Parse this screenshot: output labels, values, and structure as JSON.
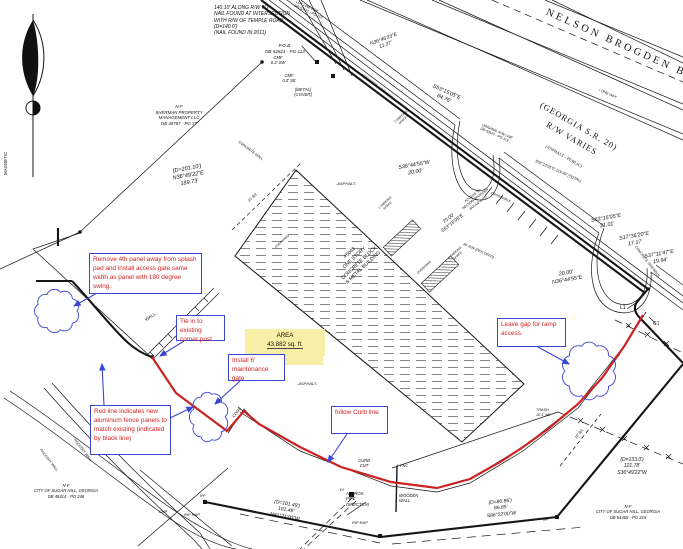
{
  "drawing_title": "site plat with fence markup",
  "area": {
    "title": "AREA",
    "value": "43,882  sq. ft."
  },
  "colors": {
    "redline": "#cc2222",
    "markup_blue": "#3a45d6",
    "callout_text": "#d42222",
    "highlight": "#f7efa6",
    "ink": "#111111"
  },
  "callouts": [
    {
      "n": "callout-remove-panel",
      "t": "Remove 4th panel away from splash pad and install access gate same width as panel with 180 degree swing.",
      "x": 89,
      "y": 253,
      "w": 113,
      "h": 41
    },
    {
      "n": "callout-tie-in",
      "t": "Tie in to existing corner post.",
      "x": 176,
      "y": 315,
      "w": 49,
      "h": 26
    },
    {
      "n": "callout-install-gate",
      "t": "Install 6' maintenance gate",
      "x": 228,
      "y": 354,
      "w": 57,
      "h": 27
    },
    {
      "n": "callout-red-line",
      "t": "Red line indicates new aluminum fence panels to match existing (indicated by black line)",
      "x": 90,
      "y": 405,
      "w": 81,
      "h": 50
    },
    {
      "n": "callout-follow-curb",
      "t": "follow Curb line",
      "x": 331,
      "y": 406,
      "w": 57,
      "h": 28
    },
    {
      "n": "callout-leave-gap",
      "t": "Leave gap for ramp access.",
      "x": 497,
      "y": 318,
      "w": 69,
      "h": 29
    }
  ],
  "labels": [
    {
      "n": "note-nail",
      "t": "140.10' ALONG R/W TO\nNAIL FOUND AT INTERSECTION\nWITH R/W OF TEMPLE ROAD\n(D=140.0')\n(NAIL FOUND IN 2011)",
      "x": 214,
      "y": 5,
      "s": 5,
      "i": 1
    },
    {
      "n": "pob",
      "t": "P.O.B.\nDB 52621 - PG 113",
      "x": 253,
      "y": 43,
      "s": 4.6,
      "a": "c",
      "w": 64,
      "i": 1
    },
    {
      "n": "cmf-sw",
      "t": "CMF\n0.3' SW",
      "x": 266,
      "y": 55,
      "s": 4.2,
      "a": "c",
      "w": 24,
      "i": 1
    },
    {
      "n": "cmf-se",
      "t": "CMF\n0.3' SE",
      "x": 277,
      "y": 73,
      "s": 4.2,
      "a": "c",
      "w": 24,
      "i": 1
    },
    {
      "n": "metal-cover",
      "t": "(METAL)\n(COVER)",
      "x": 289,
      "y": 87,
      "s": 4.2,
      "a": "c",
      "w": 28,
      "i": 1
    },
    {
      "n": "brg-n364623e",
      "t": "N36°46'23\"E\n11.37'",
      "x": 362,
      "y": 44,
      "s": 5,
      "i": 1,
      "r": -20,
      "a": "c",
      "w": 44
    },
    {
      "n": "owner-sherman",
      "t": "N-F\nSHERMAN PROPERTY\nMANAGEMENT LLC\nDB 40787 - PG 77",
      "x": 140,
      "y": 104,
      "s": 4.4,
      "a": "c",
      "w": 78,
      "i": 1
    },
    {
      "n": "brg-n364922e",
      "t": "(D=201.10')\nN36°49'22\"E\n189.73'",
      "x": 158,
      "y": 171,
      "s": 5.6,
      "i": 1,
      "r": -10,
      "a": "c",
      "w": 58
    },
    {
      "n": "brg-s531505e-84",
      "t": "S53°15'05\"E\n84.76'",
      "x": 424,
      "y": 79,
      "s": 5.4,
      "i": 1,
      "r": 24,
      "a": "c",
      "w": 52
    },
    {
      "n": "road-name",
      "t": "NELSON BROGDEN BOULEVARD",
      "x": 549,
      "y": 6,
      "s": 10.5,
      "r": 24,
      "serif": 1,
      "ls": 3,
      "w": 320
    },
    {
      "n": "road-designation",
      "t": "(GEORGIA S.R. 20)\nR/W VARIES",
      "x": 534,
      "y": 92,
      "s": 8.5,
      "r": 30,
      "serif": 1,
      "ls": 1,
      "a": "c",
      "w": 112,
      "lh": 1.7
    },
    {
      "n": "road-surface",
      "t": "(ASPHALT - PUBLIC)",
      "x": 534,
      "y": 136,
      "s": 4.4,
      "r": 30,
      "serif": 1,
      "a": "c",
      "w": 72
    },
    {
      "n": "one-way",
      "t": "• ONE WAY",
      "x": 600,
      "y": 88,
      "s": 3.6,
      "r": 24
    },
    {
      "n": "lot-line-note",
      "t": "LOT LINE PER\nDB 52621 - PG 113",
      "x": 297,
      "y": 0,
      "s": 3.5,
      "r": 24,
      "i": 1
    },
    {
      "n": "orig-rw-note",
      "t": "ORIGINAL R/W LINE\nDB 52621 - PG 113",
      "x": 483,
      "y": 123,
      "s": 3.5,
      "r": 24,
      "i": 1
    },
    {
      "n": "brg-s531505e-total",
      "t": "S53°15'05\"E 219.49' (TOTAL)",
      "x": 536,
      "y": 159,
      "s": 3.8,
      "r": 24,
      "i": 1
    },
    {
      "n": "brg-s364455w",
      "t": "S36°44'55\"W\n20.00'",
      "x": 387,
      "y": 167,
      "s": 5.4,
      "i": 1,
      "r": -10,
      "a": "c",
      "w": 54
    },
    {
      "n": "crosswalk",
      "t": "CROSSWALK",
      "x": 492,
      "y": 191,
      "s": 3.4,
      "r": 24
    },
    {
      "n": "concrete-sidewalk-1",
      "t": "CONCRETE SIDEWALK",
      "x": 363,
      "y": 73,
      "s": 3.5,
      "r": 37
    },
    {
      "n": "concrete-wall",
      "t": "CONCRETE WALL",
      "x": 240,
      "y": 140,
      "s": 3.5,
      "r": 37
    },
    {
      "n": "concrete-sidewalk-2",
      "t": "CONCRETE SIDEWALK",
      "x": 637,
      "y": 245,
      "s": 3.5,
      "r": 52
    },
    {
      "n": "bl-10-left",
      "t": "10' B/L",
      "x": 247,
      "y": 200,
      "s": 3.8,
      "r": -43,
      "i": 1
    },
    {
      "n": "rw-40",
      "t": "40' R/W (PER DEED)",
      "x": 464,
      "y": 242,
      "s": 3.5,
      "r": 24,
      "i": 1
    },
    {
      "n": "asphalt-1",
      "t": "-ASPHALT-",
      "x": 336,
      "y": 181,
      "s": 4,
      "i": 1
    },
    {
      "n": "asphalt-2",
      "t": "-ASPHALT-",
      "x": 297,
      "y": 381,
      "s": 4,
      "i": 1
    },
    {
      "n": "building-label",
      "t": "#5042\nONE STORY\nCONCRETE BLOCK\n& METAL BUILDING",
      "x": 314,
      "y": 282,
      "s": 5,
      "r": -43,
      "a": "c",
      "w": 92,
      "lh": 1.35
    },
    {
      "n": "overhang-1",
      "t": "OVERHANG",
      "x": 274,
      "y": 246,
      "s": 3.2,
      "r": -43
    },
    {
      "n": "overhang-2",
      "t": "OVERHANG",
      "x": 416,
      "y": 272,
      "s": 3.2,
      "r": -43
    },
    {
      "n": "parking-1",
      "t": "1 PARKING\nSPACE",
      "x": 374,
      "y": 210,
      "s": 3.2,
      "r": -43,
      "a": "c",
      "w": 26
    },
    {
      "n": "parking-2",
      "t": "1 PARKING\nSPACE",
      "x": 444,
      "y": 260,
      "s": 3.2,
      "r": -43,
      "a": "c",
      "w": 26
    },
    {
      "n": "parking-7",
      "t": "7 PARKING\nSPACES",
      "x": 390,
      "y": 124,
      "s": 3.2,
      "r": -43,
      "a": "c",
      "w": 26
    },
    {
      "n": "brg-s531505e-21",
      "t": "S53°15'05\"E\n21.01'",
      "x": 579,
      "y": 220,
      "s": 5.4,
      "i": 1,
      "r": -10,
      "a": "c",
      "w": 54
    },
    {
      "n": "brg-s173620e",
      "t": "S17°36'20\"E\n17.17'",
      "x": 607,
      "y": 238,
      "s": 5.4,
      "i": 1,
      "r": -10,
      "a": "c",
      "w": 54
    },
    {
      "n": "brg-s371147e",
      "t": "S37°11'47\"E\n19.94'",
      "x": 632,
      "y": 256,
      "s": 5.4,
      "i": 1,
      "r": -10,
      "a": "c",
      "w": 54
    },
    {
      "n": "brg-n364455e",
      "t": "20.00'\nN36°44'55\"E",
      "x": 539,
      "y": 275,
      "s": 5.4,
      "i": 1,
      "r": -10,
      "a": "c",
      "w": 54
    },
    {
      "n": "access-note",
      "t": "ACCESS TO\nNELSON BROGDEN\nBOULEVARD",
      "x": 455,
      "y": 207,
      "s": 3.4,
      "r": -38,
      "a": "c",
      "w": 42
    },
    {
      "n": "brg-70",
      "t": "70.00'\nS53°15'05\"E",
      "x": 431,
      "y": 230,
      "s": 4.8,
      "i": 1,
      "r": -38,
      "a": "c",
      "w": 42
    },
    {
      "n": "trash-note",
      "t": "TRASH\n10.1' NE",
      "x": 536,
      "y": 408,
      "s": 3.8,
      "i": 1
    },
    {
      "n": "bl-10-right",
      "t": "10' B/L",
      "x": 574,
      "y": 437,
      "s": 3.8,
      "r": -51,
      "i": 1
    },
    {
      "n": "conc-pad",
      "t": "CONC",
      "x": 231,
      "y": 415,
      "s": 4,
      "r": -50
    },
    {
      "n": "curb-cut",
      "t": "CURB\nCUT",
      "x": 354,
      "y": 458,
      "s": 4.2,
      "i": 1,
      "a": "c",
      "w": 20
    },
    {
      "n": "fnc-4",
      "t": "4' FNC",
      "x": 396,
      "y": 463,
      "s": 4,
      "i": 1
    },
    {
      "n": "approx-pipe",
      "t": "APPROX.\nPIPE\nDIRECTION",
      "x": 346,
      "y": 491,
      "s": 4.2,
      "i": 1
    },
    {
      "n": "wooden-wall",
      "t": "WOODEN\nWALL",
      "x": 399,
      "y": 493,
      "s": 4.2,
      "i": 1
    },
    {
      "n": "di",
      "t": "DI",
      "x": 340,
      "y": 488,
      "s": 3.6,
      "i": 1
    },
    {
      "n": "rip-rap-1",
      "t": "RIP RAP",
      "x": 184,
      "y": 512,
      "s": 4,
      "i": 1
    },
    {
      "n": "rip-rap-2",
      "t": "RIP RAP",
      "x": 352,
      "y": 520,
      "s": 4,
      "i": 1
    },
    {
      "n": "cmp",
      "t": "CMP",
      "x": 159,
      "y": 510,
      "s": 3.6,
      "i": 1
    },
    {
      "n": "brg-n812100w",
      "t": "(D=101.49')\n101.49'\nN81°21'00\"W",
      "x": 258,
      "y": 496,
      "s": 5,
      "i": 1,
      "r": 10,
      "a": "c",
      "w": 60
    },
    {
      "n": "brg-s862200w",
      "t": "(D=86.86')\n86.85'\nS86°22'00\"W",
      "x": 470,
      "y": 502,
      "s": 5,
      "i": 1,
      "r": -6,
      "a": "c",
      "w": 60
    },
    {
      "n": "brg-s364922w",
      "t": "(D=133.0')\n121.78'\nS36°49'22\"W",
      "x": 600,
      "y": 457,
      "s": 5,
      "i": 1,
      "a": "c",
      "w": 64
    },
    {
      "n": "owner-sugarhill-left",
      "t": "N-F\nCITY OF SUGAR HILL, GEORGIA\nDB 48414 - PG 248",
      "x": 6,
      "y": 483,
      "s": 4.2,
      "a": "c",
      "w": 120,
      "i": 1
    },
    {
      "n": "owner-sugarhill-right",
      "t": "N-F\nCITY OF SUGAR HILL, GEORGIA\nDB 54468 - PG 315",
      "x": 576,
      "y": 504,
      "s": 4.2,
      "a": "c",
      "w": 104,
      "i": 1
    },
    {
      "n": "magnetic",
      "t": "MAGNETIC",
      "x": 3,
      "y": 175,
      "s": 4.4,
      "r": -90
    },
    {
      "n": "l1",
      "t": "L1",
      "x": 620,
      "y": 305,
      "s": 5
    },
    {
      "n": "c1",
      "t": "C1",
      "x": 653,
      "y": 321,
      "s": 5
    },
    {
      "n": "ipf-1",
      "t": "IPF",
      "x": 200,
      "y": 494,
      "s": 3.6,
      "i": 1
    },
    {
      "n": "ipf-2",
      "t": "IPF",
      "x": 543,
      "y": 518,
      "s": 3.6,
      "i": 1
    },
    {
      "n": "rockery-wall-1",
      "t": "ROCKERY WALL",
      "x": 76,
      "y": 438,
      "s": 3.5,
      "r": 52
    },
    {
      "n": "rockery-wall-2",
      "t": "ROCKERY WALL",
      "x": 42,
      "y": 448,
      "s": 3.5,
      "r": 52
    },
    {
      "n": "wall-left",
      "t": "WALL",
      "x": 144,
      "y": 318,
      "s": 4.4,
      "r": -35
    }
  ]
}
